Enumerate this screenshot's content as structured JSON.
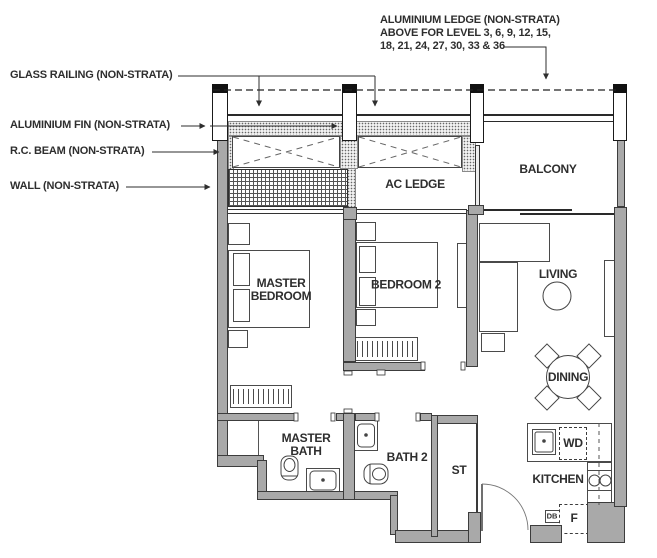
{
  "annotations": {
    "aluminium_ledge_l1": "ALUMINIUM LEDGE (NON-STRATA)",
    "aluminium_ledge_l2": "ABOVE FOR LEVEL 3, 6, 9, 12, 15,",
    "aluminium_ledge_l3": "18, 21, 24, 27, 30, 33 & 36",
    "glass_railing": "GLASS RAILING (NON-STRATA)",
    "aluminium_fin": "ALUMINIUM FIN (NON-STRATA)",
    "rc_beam": "R.C. BEAM (NON-STRATA)",
    "wall": "WALL (NON-STRATA)"
  },
  "rooms": {
    "balcony": "BALCONY",
    "ac_ledge": "AC LEDGE",
    "master_bedroom": "MASTER BEDROOM",
    "bedroom2": "BEDROOM 2",
    "living": "LIVING",
    "dining": "DINING",
    "master_bath": "MASTER BATH",
    "bath2": "BATH 2",
    "store": "ST",
    "kitchen": "KITCHEN"
  },
  "appliances": {
    "washer_dryer": "WD",
    "fridge": "F",
    "db": "DB"
  },
  "colors": {
    "wall_fill": "#a9a9a9",
    "line": "#3c3c3c",
    "text": "#2e2e2e",
    "background": "#ffffff"
  }
}
